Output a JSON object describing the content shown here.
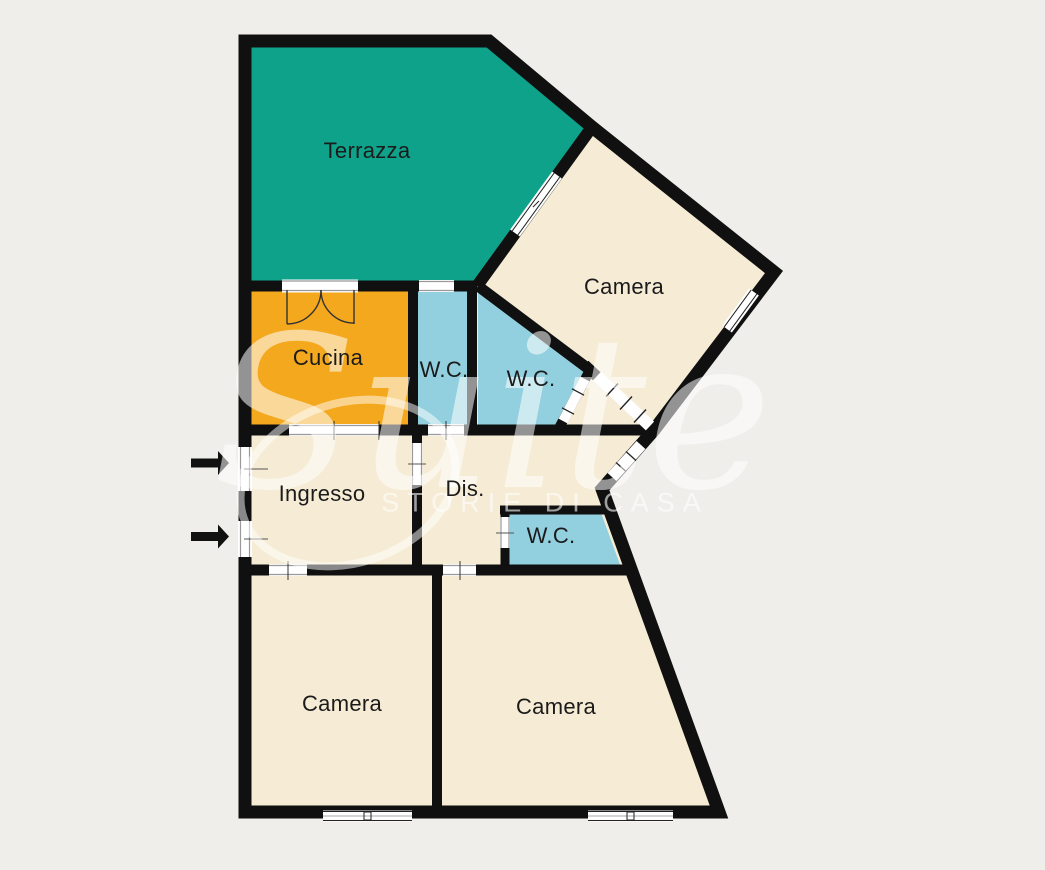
{
  "watermark": {
    "brand": "Suite",
    "tagline": "STORIE DI CASA"
  },
  "plan": {
    "rooms": [
      {
        "id": "terrazza",
        "label": "Terrazza"
      },
      {
        "id": "camera-nordest",
        "label": "Camera"
      },
      {
        "id": "cucina",
        "label": "Cucina"
      },
      {
        "id": "wc-nord",
        "label": "W.C."
      },
      {
        "id": "wc-centro",
        "label": "W.C."
      },
      {
        "id": "ingresso",
        "label": "Ingresso"
      },
      {
        "id": "disimpegno",
        "label": "Dis."
      },
      {
        "id": "wc-sud",
        "label": "W.C."
      },
      {
        "id": "camera-sudovest",
        "label": "Camera"
      },
      {
        "id": "camera-sudest",
        "label": "Camera"
      }
    ],
    "colors": {
      "background": "#f0eeea",
      "floor": "#f6ecd5",
      "terrace": "#0ea28b",
      "kitchen": "#f4a81d",
      "bathroom": "#92d0df",
      "walls": "#101010",
      "label_text": "#1b1b1b",
      "watermark": "#ffffff"
    },
    "symbols": {
      "entrance_arrow_count": 2,
      "entrance_arrow_meaning": "entrance direction arrows"
    }
  }
}
